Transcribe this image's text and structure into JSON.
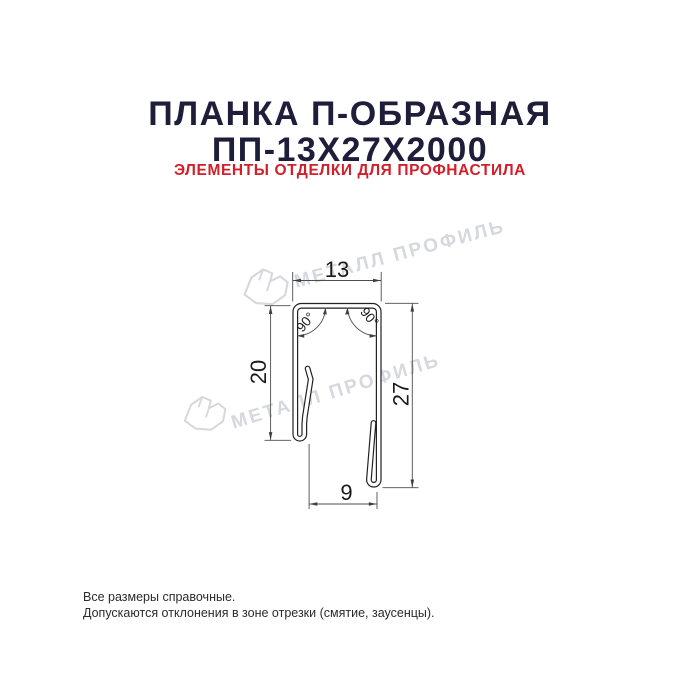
{
  "header": {
    "title_line1": "ПЛАНКА П-ОБРАЗНАЯ",
    "title_line2": "ПП-13Х27Х2000",
    "subtitle": "ЭЛЕМЕНТЫ ОТДЕЛКИ ДЛЯ ПРОФНАСТИЛА",
    "title_color": "#1e1d3a",
    "subtitle_color": "#d1202a"
  },
  "drawing": {
    "type": "profile-cross-section",
    "dimensions": {
      "top_width": "13",
      "left_height": "20",
      "right_height": "27",
      "bottom_width": "9"
    },
    "angles": {
      "left": "90°",
      "right": "90°"
    },
    "line_color": "#222222",
    "dim_color": "#4d4d4d"
  },
  "watermark": {
    "text": "МЕТАЛЛ ПРОФИЛЬ",
    "color": "#d5d8de"
  },
  "footer": {
    "line1": "Все размеры справочные.",
    "line2": "Допускаются отклонения в зоне отрезки (смятие, заусенцы)."
  }
}
